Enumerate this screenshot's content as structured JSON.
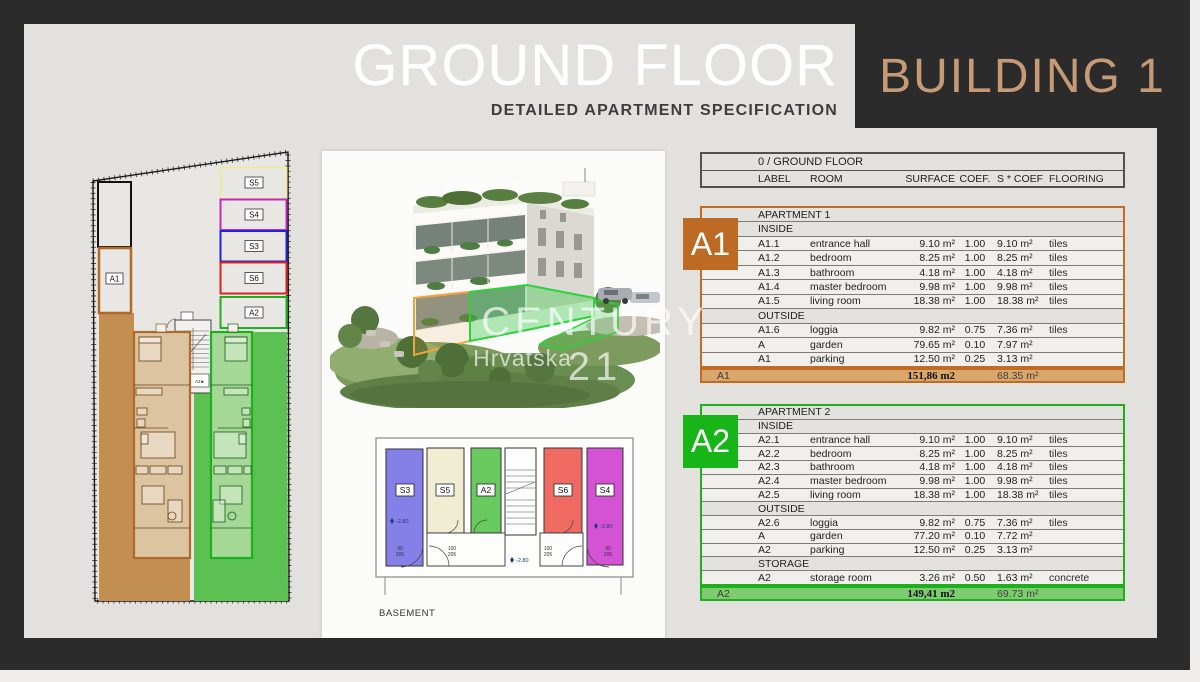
{
  "header": {
    "title_left": "GROUND FLOOR",
    "subtitle": "DETAILED APARTMENT SPECIFICATION",
    "title_right": "BUILDING 1"
  },
  "watermark": {
    "line1": "CENTURY 21",
    "line2": "Hrvatska"
  },
  "colors": {
    "background_dark": "#2b2b2b",
    "panel": "#e3e1dd",
    "accent_bronze": "#c69a75",
    "a1_orange": "#bf6c25",
    "a1_total_fill": "#d9a76b",
    "a2_green": "#1daf1d",
    "a2_total_fill": "#7ecb70",
    "s3_blue": "#2323d8",
    "s4_magenta": "#c22ac2",
    "s5_yellow": "#efe9a0",
    "s6_red": "#d82323",
    "basement_s3_fill": "#8480e8",
    "basement_s5_fill": "#f1edd3",
    "basement_a2_fill": "#68c95f",
    "basement_s6_fill": "#ef6a60",
    "basement_s4_fill": "#d453d4"
  },
  "site_plan": {
    "labels": {
      "a1": "A1",
      "a2": "A2",
      "s3": "S3",
      "s4": "S4",
      "s5": "S5",
      "s6": "S6",
      "stair_a1": "◄A1",
      "stair_a2": "A2►"
    }
  },
  "basement": {
    "caption": "BASEMENT",
    "labels": {
      "s3": "S3",
      "s5": "S5",
      "a2": "A2",
      "s6": "S6",
      "s4": "S4"
    },
    "dims": {
      "w90": "90",
      "h205": "205",
      "w100": "100",
      "elev": "-2.80"
    }
  },
  "spec_header": {
    "floor": "0 / GROUND FLOOR",
    "columns": [
      "LABEL",
      "ROOM",
      "SURFACE",
      "COEF.",
      "S * COEF",
      "FLOORING"
    ]
  },
  "apartments": [
    {
      "badge": "A1",
      "title": "APARTMENT 1",
      "sections": [
        {
          "name": "INSIDE",
          "rows": [
            [
              "A1.1",
              "entrance hall",
              "9.10 m²",
              "1.00",
              "9.10 m²",
              "tiles"
            ],
            [
              "A1.2",
              "bedroom",
              "8.25 m²",
              "1.00",
              "8.25 m²",
              "tiles"
            ],
            [
              "A1.3",
              "bathroom",
              "4.18 m²",
              "1.00",
              "4.18 m²",
              "tiles"
            ],
            [
              "A1.4",
              "master bedroom",
              "9.98 m²",
              "1.00",
              "9.98 m²",
              "tiles"
            ],
            [
              "A1.5",
              "living room",
              "18.38 m²",
              "1.00",
              "18.38 m²",
              "tiles"
            ]
          ]
        },
        {
          "name": "OUTSIDE",
          "rows": [
            [
              "A1.6",
              "loggia",
              "9.82 m²",
              "0.75",
              "7.36 m²",
              "tiles"
            ],
            [
              "A",
              "garden",
              "79.65 m²",
              "0.10",
              "7.97 m²",
              ""
            ],
            [
              "A1",
              "parking",
              "12.50 m²",
              "0.25",
              "3.13 m²",
              ""
            ]
          ]
        }
      ],
      "total": {
        "label": "A1",
        "surface": "151,86 m2",
        "coef": "68.35 m²"
      }
    },
    {
      "badge": "A2",
      "title": "APARTMENT 2",
      "sections": [
        {
          "name": "INSIDE",
          "rows": [
            [
              "A2.1",
              "entrance hall",
              "9.10 m²",
              "1.00",
              "9.10 m²",
              "tiles"
            ],
            [
              "A2.2",
              "bedroom",
              "8.25 m²",
              "1.00",
              "8.25 m²",
              "tiles"
            ],
            [
              "A2.3",
              "bathroom",
              "4.18 m²",
              "1.00",
              "4.18 m²",
              "tiles"
            ],
            [
              "A2.4",
              "master bedroom",
              "9.98 m²",
              "1.00",
              "9.98 m²",
              "tiles"
            ],
            [
              "A2.5",
              "living room",
              "18.38 m²",
              "1.00",
              "18.38 m²",
              "tiles"
            ]
          ]
        },
        {
          "name": "OUTSIDE",
          "rows": [
            [
              "A2.6",
              "loggia",
              "9.82 m²",
              "0.75",
              "7.36 m²",
              "tiles"
            ],
            [
              "A",
              "garden",
              "77.20 m²",
              "0.10",
              "7.72 m²",
              ""
            ],
            [
              "A2",
              "parking",
              "12.50 m²",
              "0.25",
              "3.13 m²",
              ""
            ]
          ]
        },
        {
          "name": "STORAGE",
          "rows": [
            [
              "A2",
              "storage room",
              "3.26 m²",
              "0.50",
              "1.63 m²",
              "concrete"
            ]
          ]
        }
      ],
      "total": {
        "label": "A2",
        "surface": "149,41 m2",
        "coef": "69.73 m²"
      }
    }
  ]
}
